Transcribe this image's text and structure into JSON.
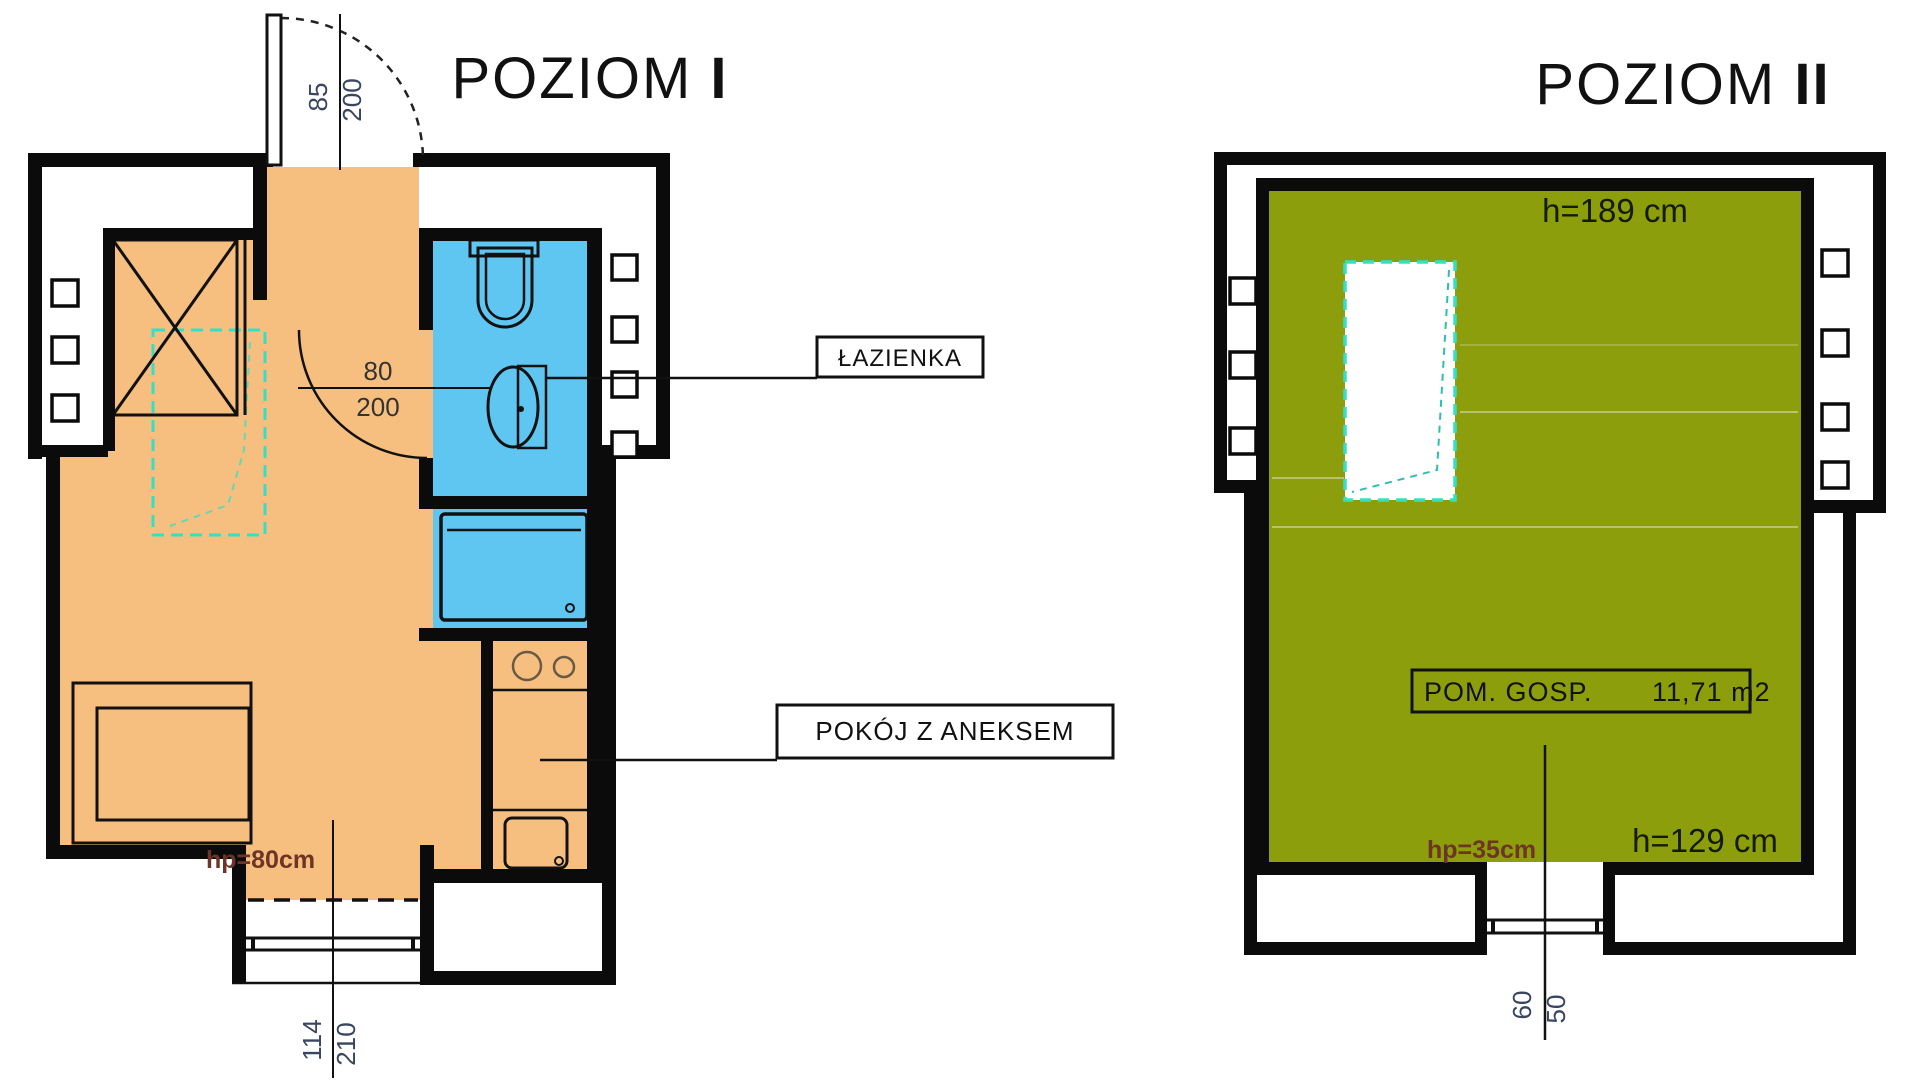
{
  "colors": {
    "orange": "#F6BF7F",
    "blue": "#5FC6F2",
    "green": "#8C9E0C",
    "teal": "#35DFC6",
    "wall": "#0B0B0B",
    "dim_text": "#3A4660",
    "parapet_text": "#6D3526",
    "light_line": "#B9C26A"
  },
  "level1": {
    "title": "POZIOM",
    "numeral": "I",
    "entry_door": {
      "width": "85",
      "height": "200"
    },
    "bath_door": {
      "width": "80",
      "height": "200"
    },
    "window": {
      "width": "114",
      "height": "210"
    },
    "parapet": "hp=80cm",
    "bathroom_label": "ŁAZIENKA",
    "room_label": "POKÓJ Z ANEKSEM"
  },
  "level2": {
    "title": "POZIOM",
    "numeral": "II",
    "ceiling_height_top": "h=189 cm",
    "room_name": "POM. GOSP.",
    "room_area": "11,71 m2",
    "parapet": "hp=35cm",
    "ceiling_height_bottom": "h=129 cm",
    "window": {
      "width": "60",
      "height": "50"
    }
  }
}
